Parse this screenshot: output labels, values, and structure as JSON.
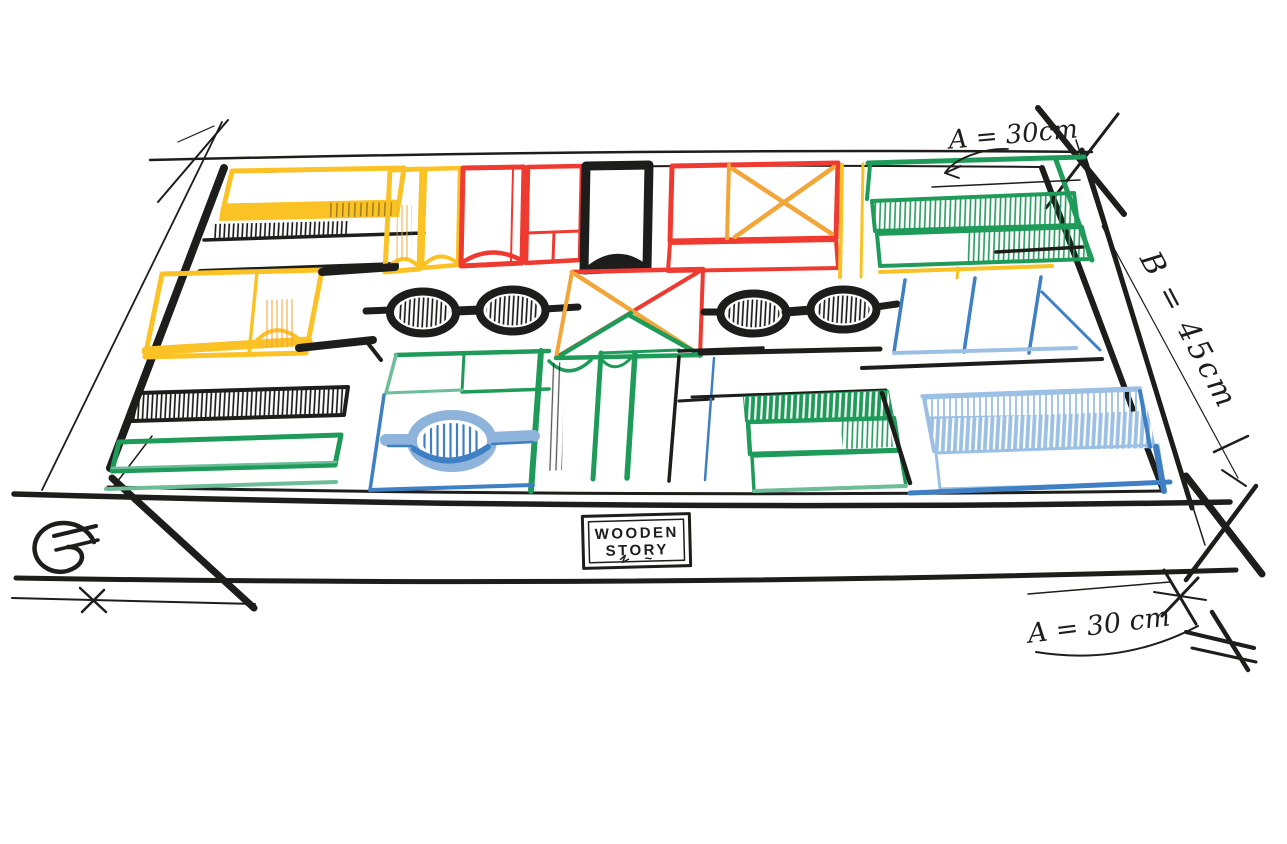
{
  "sketch": {
    "subject": "Hand-drawn perspective sketch of a wooden tray filled with colorful building blocks",
    "brand_label": {
      "line1": "WOODEN",
      "line2": "STORY",
      "flourish": "~"
    },
    "annotations": {
      "dim_top": "A = 30cm",
      "dim_right": "B = 45cm",
      "dim_bottom": "A = 30 cm"
    },
    "palette": {
      "ink": "#1d1d1b",
      "yellow": "#fbc226",
      "orange": "#f2a63a",
      "red": "#ee3a30",
      "green": "#1f9b59",
      "teal": "#6dbd98",
      "blue": "#3f7fc3",
      "light_blue": "#9cc0e4",
      "paper": "#ffffff"
    },
    "block_groups": [
      {
        "name": "back-row-yellow-planks",
        "color": "yellow"
      },
      {
        "name": "back-row-hatched-plank",
        "color": "ink",
        "pattern": "hatch"
      },
      {
        "name": "back-row-yellow-arch-columns",
        "color": "yellow"
      },
      {
        "name": "back-row-red-arch-column",
        "color": "red"
      },
      {
        "name": "back-row-red-frame",
        "color": "red"
      },
      {
        "name": "back-row-black-arch-column",
        "color": "ink"
      },
      {
        "name": "back-row-red-frame-with-orange-cross",
        "colors": [
          "red",
          "orange"
        ]
      },
      {
        "name": "back-row-green-hatched-planks",
        "color": "green",
        "pattern": "hatch"
      },
      {
        "name": "middle-row-yellow-arch-block",
        "color": "yellow"
      },
      {
        "name": "middle-row-goggle-blocks-left",
        "color": "ink",
        "pattern": "hatch"
      },
      {
        "name": "middle-row-cross-square",
        "colors": [
          "red",
          "orange",
          "green"
        ]
      },
      {
        "name": "middle-row-goggle-blocks-right",
        "color": "ink",
        "pattern": "hatch"
      },
      {
        "name": "middle-row-blue-framed-cells",
        "colors": [
          "yellow",
          "blue"
        ]
      },
      {
        "name": "front-row-black-hatched-plank",
        "color": "ink",
        "pattern": "hatch"
      },
      {
        "name": "front-row-green-plank",
        "color": "green"
      },
      {
        "name": "front-row-green-grid-with-blue-oval",
        "colors": [
          "green",
          "teal",
          "blue"
        ],
        "pattern": "hatch"
      },
      {
        "name": "front-row-arch-columns",
        "colors": [
          "green",
          "ink",
          "blue"
        ]
      },
      {
        "name": "front-row-green-hatched-planks",
        "color": "green",
        "pattern": "hatch"
      },
      {
        "name": "front-row-blue-hatched-planks",
        "color": "light_blue",
        "pattern": "hatch"
      }
    ]
  }
}
